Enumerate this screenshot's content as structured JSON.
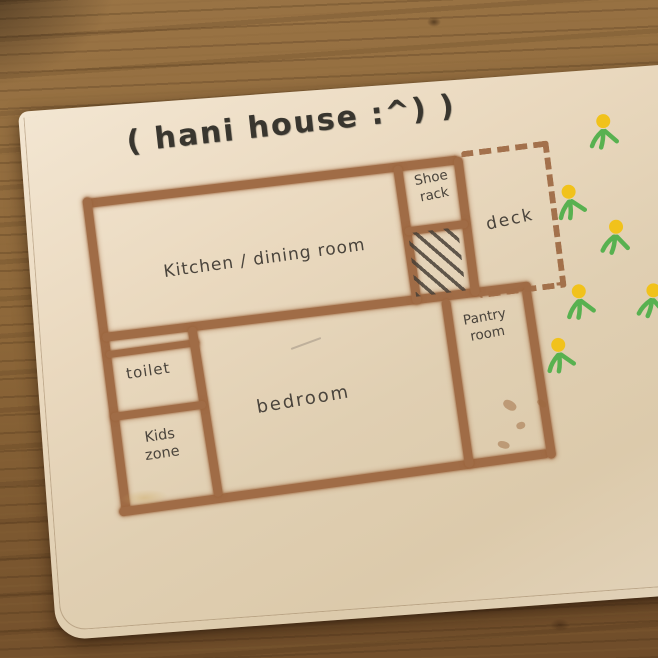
{
  "title": "( hani house :^) )",
  "plan": {
    "rooms": [
      {
        "id": "kitchen",
        "label": "Kitchen / dining room"
      },
      {
        "id": "shoe-rack",
        "label": "Shoe rack"
      },
      {
        "id": "deck",
        "label": "deck"
      },
      {
        "id": "toilet",
        "label": "toilet"
      },
      {
        "id": "bedroom",
        "label": "bedroom"
      },
      {
        "id": "pantry",
        "label": "Pantry room"
      },
      {
        "id": "kids-zone",
        "label": "Kids zone"
      }
    ]
  },
  "doodles": {
    "flower_count": 6,
    "flower_color": "#f1c21b",
    "leaf_color": "#58b150"
  },
  "colors": {
    "crayon_brown": "#a06c46",
    "pencil_text": "#4a443c",
    "paper": "#e2d1b5",
    "wood": "#8f6a3c"
  }
}
